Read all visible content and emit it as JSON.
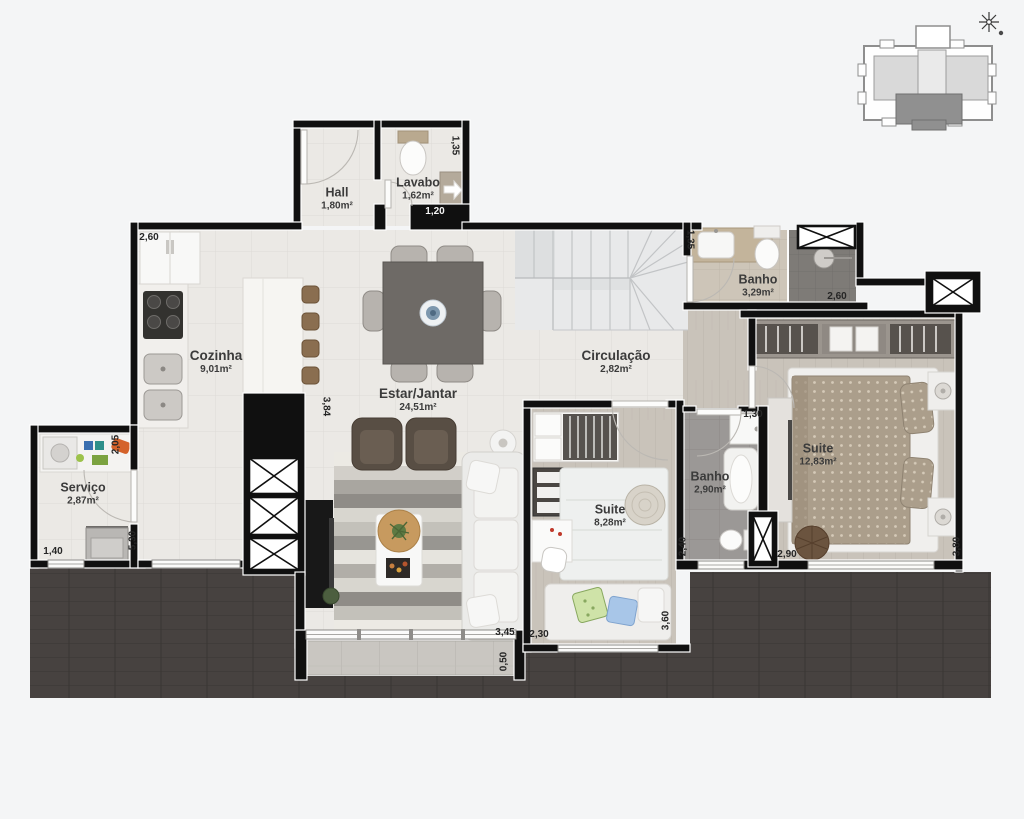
{
  "plan": {
    "rooms": [
      {
        "label": "Hall",
        "area": "1,80m²"
      },
      {
        "label": "Lavabo",
        "area": "1,62m²"
      },
      {
        "label": "Cozinha",
        "area": "9,01m²"
      },
      {
        "label": "Estar/Jantar",
        "area": "24,51m²"
      },
      {
        "label": "Circulação",
        "area": "2,82m²"
      },
      {
        "label": "Banho",
        "area": "3,29m²"
      },
      {
        "label": "Suite",
        "area": "12,83m²"
      },
      {
        "label": "Banho",
        "area": "2,90m²"
      },
      {
        "label": "Suite",
        "area": "8,28m²"
      },
      {
        "label": "Serviço",
        "area": "2,87m²"
      }
    ],
    "dimensions": [
      "1,35",
      "1,20",
      "2,60",
      "3,84",
      "1,35",
      "2,60",
      "1,30",
      "2,40",
      "2,90",
      "3,80",
      "2,30",
      "3,60",
      "3,45",
      "0,50",
      "1,40",
      "5,30",
      "2,05"
    ],
    "colors": {
      "wall": "#101010",
      "floor_tile": "#ebe9e5",
      "floor_wood": "#c9c3ba",
      "bath_gray": "#9b9896",
      "bath_beige": "#cdc5b8",
      "terrace": "#474240",
      "keyplan_highlight": "#909090"
    },
    "icons": {
      "compass": "compass-north-icon",
      "shaft": "shaft-x-icon",
      "entry_arrow": "arrow-right-icon"
    }
  }
}
